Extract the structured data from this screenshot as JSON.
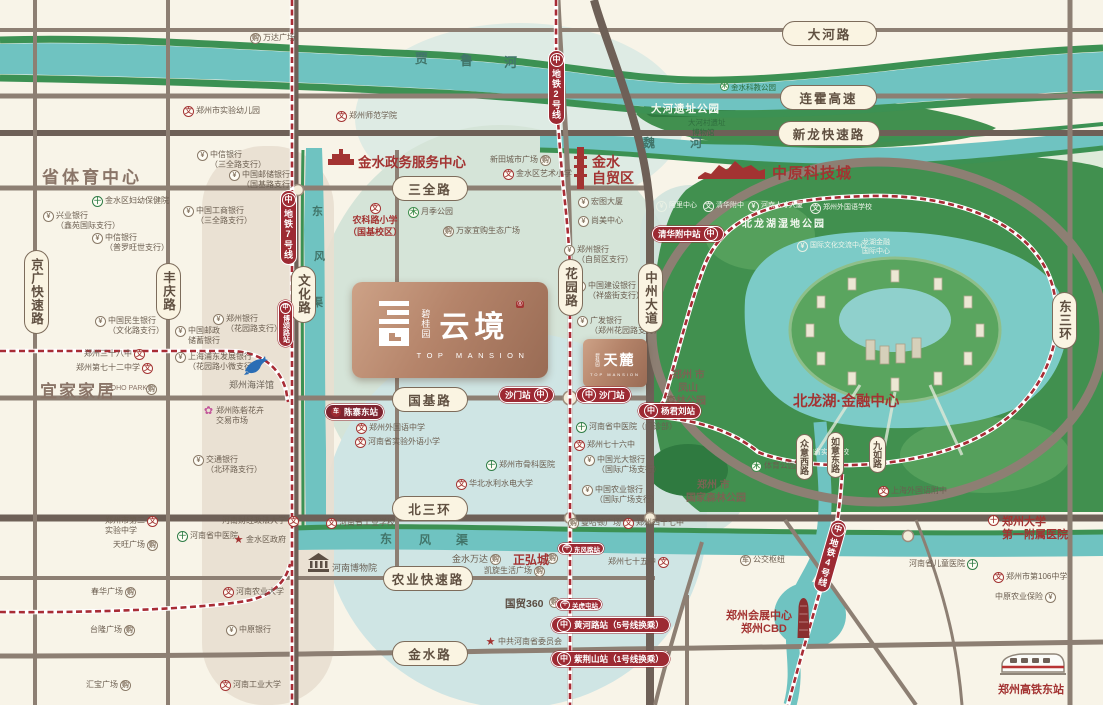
{
  "colors": {
    "metro_red": "#9d2a33",
    "road_grey": "#8d7f73",
    "road_dark": "#6e6057",
    "river_teal": "#6fc3c1",
    "bank_green": "#3c9153",
    "park_green": "#41904f",
    "bronze": "#b5846a",
    "label_red": "#a33332",
    "pill_cream": "#faf4e2"
  },
  "icons": {
    "metro": "中",
    "school": "文",
    "bank": "¥",
    "hospital": "十",
    "shop": "购",
    "park": "木",
    "star": "★",
    "flower": "✿",
    "vehicle": "车"
  },
  "project": {
    "brand": "碧桂园",
    "name": "云境",
    "seal": "®",
    "sub": "TOP MANSION"
  },
  "project2": {
    "brand": "碧桂园",
    "name": "天麓",
    "sub": "TOP MANSION"
  },
  "rivers": {
    "jialu": [
      "贾",
      "鲁",
      "河"
    ],
    "wei": [
      "魏",
      "河"
    ],
    "dongfeng_v": [
      "东",
      "风",
      "渠"
    ],
    "dongfeng_h": [
      "东",
      "风",
      "渠"
    ]
  },
  "roads": {
    "dahe": "大河路",
    "lianhuo": "连霍高速",
    "xinlong": "新龙快速路",
    "sanquan": "三全路",
    "guoji": "国基路",
    "beisanhuan": "北三环",
    "nongye": "农业快速路",
    "jinshui": "金水路",
    "jingguang": "京广快速路",
    "fengqing": "丰庆路",
    "wenhua": "文化路",
    "huayuan": "花园路",
    "zhongzhou": "中州大道",
    "dongsanhuan": "东三环",
    "zhongyixi": "众意西路",
    "ruyidong": "如意东路",
    "jiuru": "九如路"
  },
  "metro": {
    "line2": "地铁2号线",
    "line7": "地铁7号线",
    "line4": "地铁4号线",
    "st_shamen_w": "沙门站",
    "st_shamen_e": "沙门站",
    "st_yangjunliu": "杨君刘站",
    "st_qinghua": "清华附中站",
    "st_huanghe": "黄河路站（5号线换乘）",
    "st_zijingshan": "紫荆山站（1号线换乘）",
    "st_guanhutun": "关虎屯站",
    "st_dongfeng": "东风路站",
    "st_bosong": "博颂路站",
    "st_chenzhai": "陈寨东站"
  },
  "landmarks": {
    "sports": "省体育中心",
    "ikea": "宜家家居",
    "ikea_en": "YOHO PARK",
    "aquarium": "郑州海洋馆",
    "gov_center": "金水政务服务中心",
    "ftz_l1": "金水",
    "ftz_l2": "自贸区",
    "tech_city": "中原科技城",
    "dahe_park": "大河遗址公园",
    "kejiao_park": "金水科教公园",
    "dahecun_l1": "大河村遗址",
    "dahecun_l2": "博物馆",
    "wetland": "北龙湖湿地公园",
    "finance": "北龙湖·金融中心",
    "fengshan_l1": "郑州 市",
    "fengshan_l2": "凤山",
    "fengshan_l3": "森林公园",
    "nforest_l1": "郑州 市",
    "nforest_l2": "国家森林公园",
    "cbd_l1": "郑州会展中心",
    "cbd_l2": "郑州CBD",
    "zzu_l1": "郑州大学",
    "zzu_l2": "第一附属医院",
    "hsr": "郑州高铁东站",
    "museum": "河南博物院",
    "committee": "中共河南省委员会",
    "guomao": "国贸360",
    "zhenghong": "正弘城",
    "jswanda": "金水万达"
  },
  "pois": {
    "wanda": "万达广场",
    "kinder": "郑州市实验幼儿园",
    "normal": "郑州师范学院",
    "xintian": "新田城市广场",
    "art_school": "金水区艺术小学",
    "nongke_l1": "农科路小学",
    "nongke_l2": "（国基校区）",
    "yueji": "月季公园",
    "wanjia": "万家宜购生态广场",
    "hongtu": "宏图大厦",
    "shangmei": "尚美中心",
    "zzbank1_l1": "郑州银行",
    "zzbank1_l2": "（自贸区支行）",
    "ccb_l1": "中国建设银行",
    "ccb_l2": "（祥盛街支行）",
    "cgb_l1": "广发银行",
    "cgb_l2": "（郑州花园路支行）",
    "ali": "阿里中心",
    "qhfz": "清华附中",
    "rencai": "河南人才大厦",
    "waiguoyu": "郑州外国语学校",
    "wenhua_center": "国际文化交流中心",
    "lhjr_l1": "龙湖金融",
    "lhjr_l2": "国际中心",
    "citic1_l1": "中信银行",
    "citic1_l2": "（三全路支行）",
    "psbc1_l1": "中国邮储银行",
    "psbc1_l2": "（国基路支行）",
    "fuyou": "金水区妇幼保健院",
    "xingye_l1": "兴业银行",
    "xingye_l2": "（鑫苑国际支行）",
    "icbc_l1": "中国工商银行",
    "icbc_l2": "（三全路支行）",
    "citic2_l1": "中信银行",
    "citic2_l2": "（普罗旺世支行）",
    "minsheng_l1": "中国民生银行",
    "minsheng_l2": "（文化路支行）",
    "psbc2_l1": "中国邮政",
    "psbc2_l2": "储蓄银行",
    "zzbank2_l1": "郑州银行",
    "zzbank2_l2": "（花园路支行）",
    "spdb_l1": "上海浦东发展银行",
    "spdb_l2": "（花园路小微支行）",
    "s38": "郑州三十八中",
    "s72": "郑州第七十二中学",
    "flower_l1": "郑州陈砦花卉",
    "flower_l2": "交易市场",
    "boc_l1": "交通银行",
    "boc_l2": "（北环路支行）",
    "shiyan_l1": "郑州市第二",
    "shiyan_l2": "实验中学",
    "tianwang": "天旺广场",
    "caida": "河南财经政法大学",
    "zhongyi": "河南省中医院",
    "jsgov": "金水区政府",
    "nongda": "河南农业大学",
    "chunhua": "春华广场",
    "gongye": "河南省工业学校",
    "manha": "曼哈顿广场",
    "s47": "郑州四十七中",
    "kaixuan": "凯旋生活广场",
    "s75": "郑州七十五中",
    "foreign_m": "郑州外国语中学",
    "exp_p": "河南省实验外语小学",
    "bone": "郑州市骨科医院",
    "huabei": "华北水利水电大学",
    "zhongyi2": "河南省中医院（门诊部）",
    "s76": "郑州七十六中",
    "guangda_l1": "中国光大银行",
    "guangda_l2": "（国际广场支行）",
    "nonghang_l1": "中国农业银行",
    "nonghang_l2": "（国际广场支行）",
    "typark": "体育公园",
    "sy": "河南省实验学校",
    "shfz": "上海外国语附中",
    "bus": "公交枢纽",
    "children": "河南省儿童医院",
    "s106": "郑州市第106中学",
    "insurance": "中原农业保险",
    "tailong": "台隆广场",
    "zybank": "中原银行",
    "gongda": "河南工业大学",
    "huibao": "汇宝广场"
  }
}
